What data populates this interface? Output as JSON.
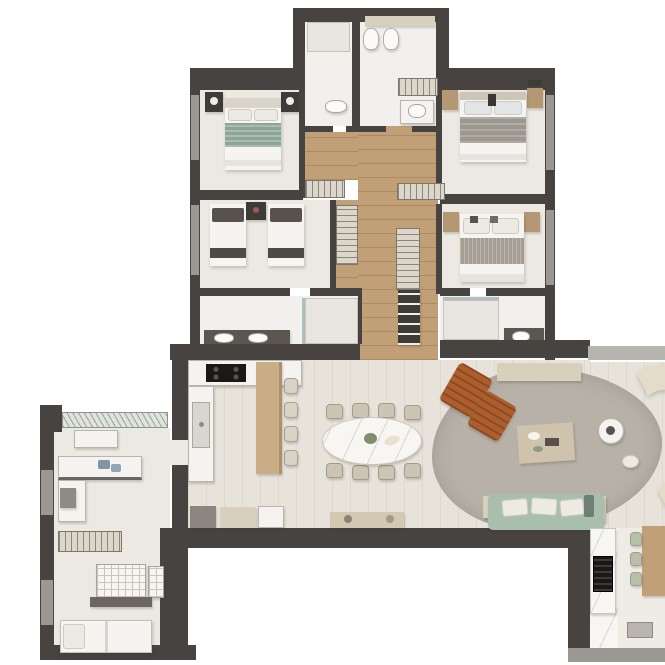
{
  "title": "apartment-floor-plan",
  "palette": {
    "wall": "#474340",
    "wall-light": "#9b9893",
    "glass": "#b7b4af",
    "floor": "#ece9e2",
    "floor-bath": "#f2f0ec",
    "plank": "#e7e3db",
    "plank-line": "#ded8ce",
    "wood": "#c2a077",
    "wood-dark": "#ac8a62",
    "island": "#c9ad87",
    "counter": "#f4f3ef",
    "counter-edge": "#b9b5ad",
    "dark-furn": "#3f3b37",
    "hatch-base": "#ddd6ca",
    "hatch-line": "#8d867c",
    "rug": "#b7b1a8",
    "leather": "#ad5e2e",
    "leather-dark": "#8d4a22",
    "cream": "#e4dcc8",
    "green-sofa": "#a9bfae",
    "cushion": "#edeae3",
    "marble": "#f7f6f2",
    "marble-vein": "#d9d5cf",
    "terrace": "#efece6",
    "bed-white": "#f5f4f0",
    "bed-green": "#8ea495",
    "bed-gray": "#9c978f",
    "bed-taupe": "#a59e93",
    "pillow-dark": "#57534c",
    "chair": "#ccc5b5",
    "black": "#1a1918"
  },
  "rooms": [
    "bathroom-suite-top",
    "wc-top",
    "bedroom-top-left",
    "bedroom-mid-left",
    "bathroom-left",
    "hallway",
    "bedroom-top-right",
    "bedroom-mid-right",
    "bathroom-right",
    "kitchen",
    "dining-area",
    "living-room",
    "terrace-gourmet",
    "service-laundry",
    "maid-room"
  ],
  "inventory": {
    "double_beds": 3,
    "twin_beds": 2,
    "single_beds": 1,
    "toilets": 2,
    "showers": 3,
    "dining_chairs": 8,
    "island_stools": 4,
    "terrace_chairs": 3,
    "leather_armchairs": 2,
    "sofas": 2,
    "washer_dryer_units": 2,
    "wardrobes": 5,
    "grill": 1
  }
}
